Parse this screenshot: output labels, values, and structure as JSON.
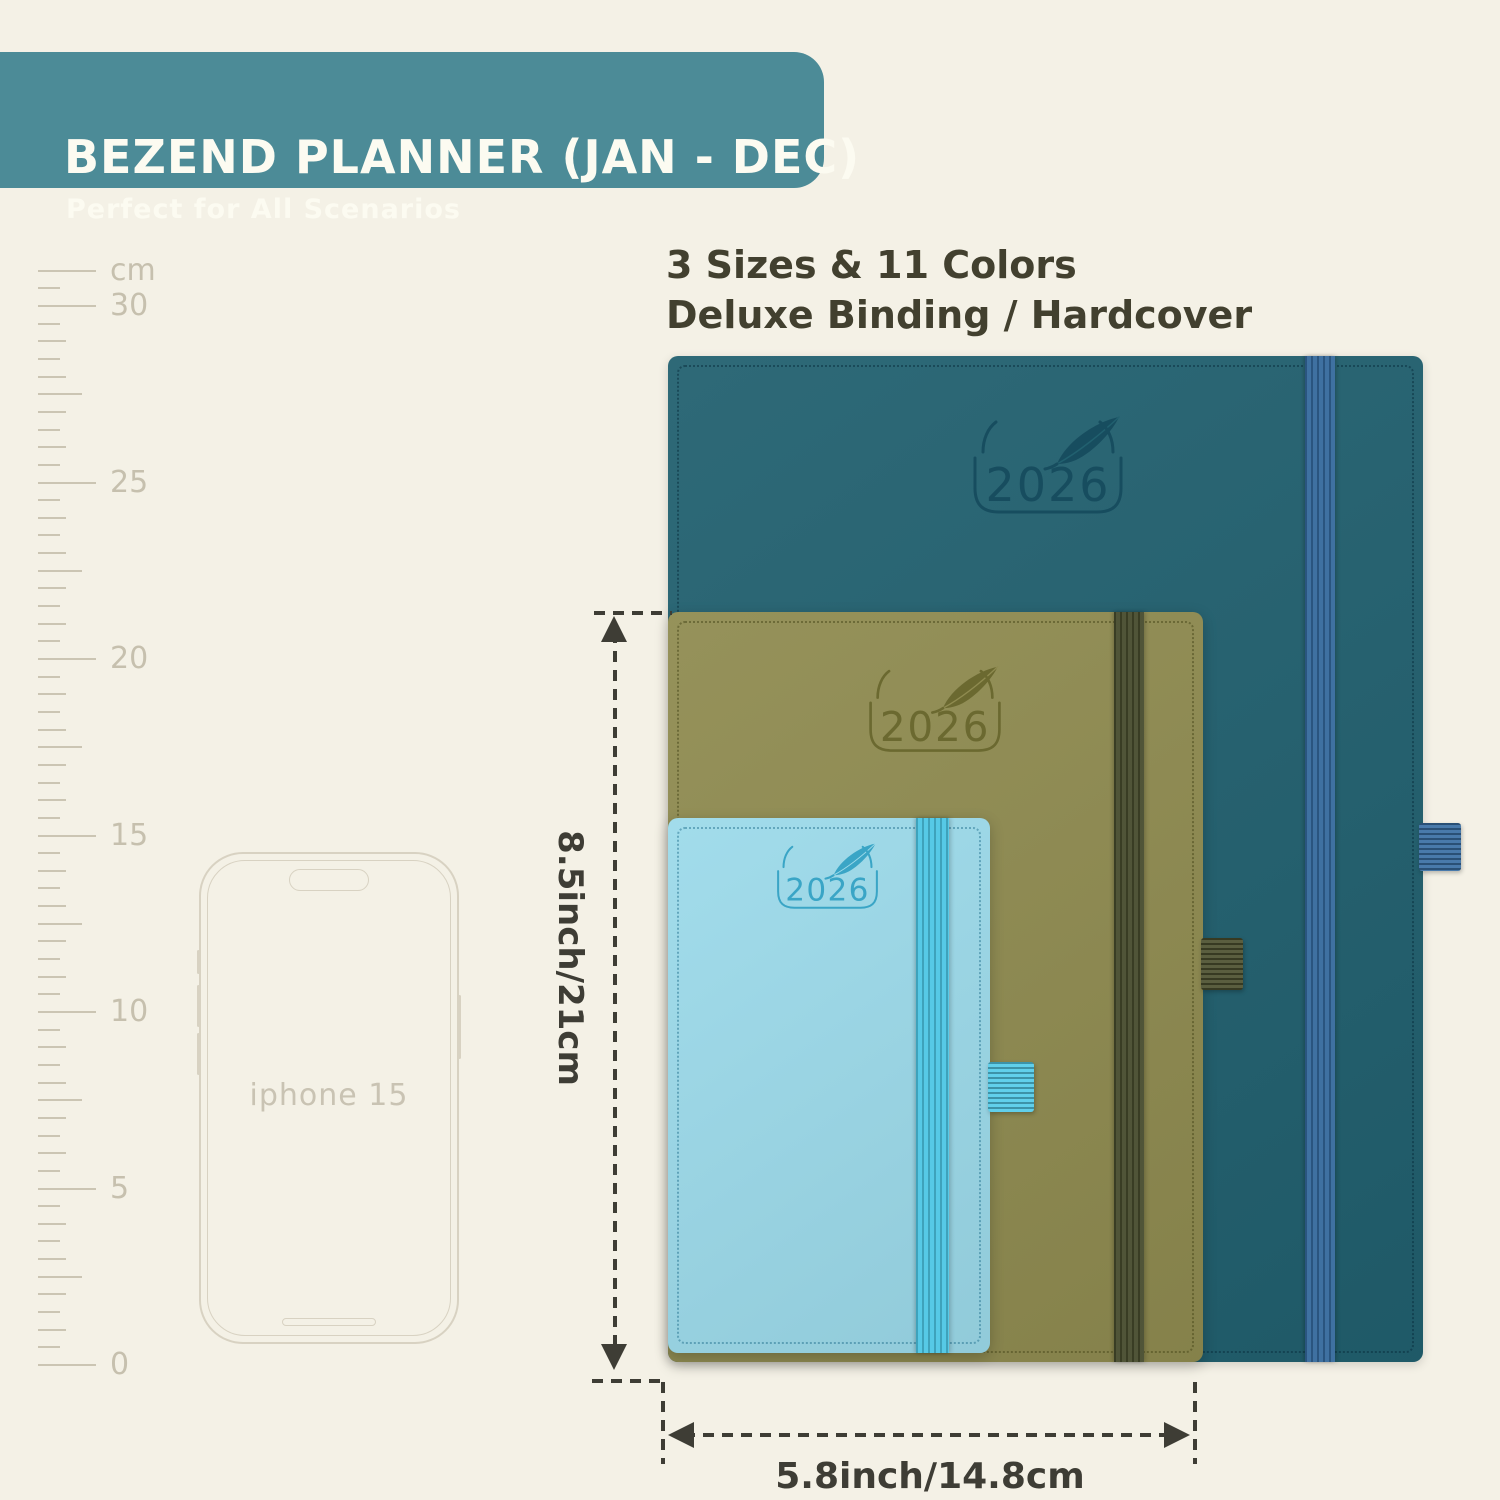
{
  "page": {
    "bg_color": "#f4f1e6"
  },
  "header": {
    "title": "BEZEND PLANNER (JAN - DEC)",
    "subtitle": "Perfect for All Scenarios",
    "bg_color": "#4c8b97",
    "text_color": "#fcfbf1"
  },
  "features": {
    "line1": "3 Sizes & 11 Colors",
    "line2": "Deluxe Binding / Hardcover",
    "text_color": "#42402f"
  },
  "ruler": {
    "unit_label": "cm",
    "labels": [
      0,
      5,
      10,
      15,
      20,
      25,
      30
    ],
    "tick_color": "#cbc5b3",
    "label_color": "#c6c0ae"
  },
  "phone": {
    "label": "iphone 15",
    "outline_color": "#d8d2c2",
    "label_color": "#c9c3b3"
  },
  "planners": [
    {
      "size": "large",
      "year": "2026",
      "cover_color": "#21606f",
      "emboss_color": "#174d5f",
      "stitch_color": "rgba(8,45,60,0.5)",
      "band_color": "#33689b",
      "loop_color": "#3a6fa4"
    },
    {
      "size": "medium",
      "year": "2026",
      "cover_color": "#8f8b50",
      "emboss_color": "#6b6930",
      "stitch_color": "rgba(70,70,25,0.5)",
      "band_color": "#454a2c",
      "loop_color": "#4c502f"
    },
    {
      "size": "small",
      "year": "2026",
      "cover_color": "#9cdaea",
      "emboss_color": "#3aa5c6",
      "stitch_color": "rgba(25,105,135,0.45)",
      "band_color": "#4cc6e4",
      "loop_color": "#54cbe8"
    }
  ],
  "dimensions": {
    "height_label": "8.5inch/21cm",
    "width_label": "5.8inch/14.8cm",
    "color": "#3e3d35"
  }
}
